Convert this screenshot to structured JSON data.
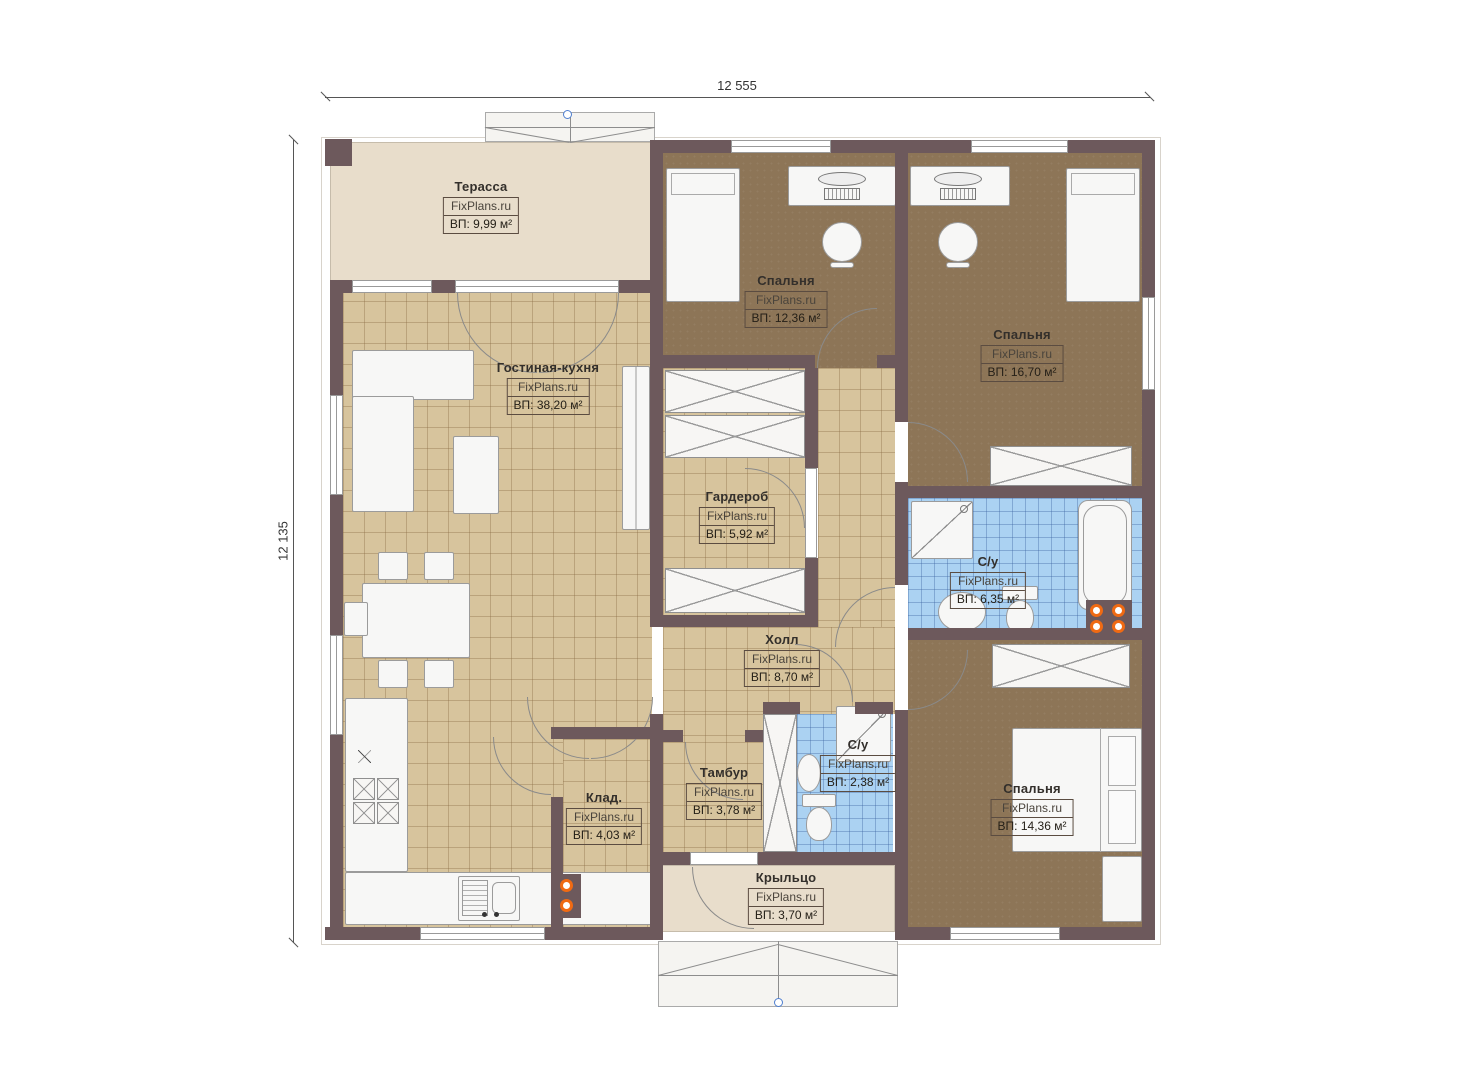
{
  "watermark": "FixPlans.ru",
  "dimensions": {
    "width_top": "12 555",
    "height_left": "12 135"
  },
  "rooms": {
    "terrace": {
      "name": "Терасса",
      "area": "ВП: 9,99 м²"
    },
    "living": {
      "name": "Гостиная-кухня",
      "area": "ВП: 38,20 м²"
    },
    "bedroom1": {
      "name": "Спальня",
      "area": "ВП: 12,36 м²"
    },
    "bedroom2": {
      "name": "Спальня",
      "area": "ВП: 16,70 м²"
    },
    "wardrobe": {
      "name": "Гардероб",
      "area": "ВП: 5,92 м²"
    },
    "bath1": {
      "name": "С/у",
      "area": "ВП: 6,35 м²"
    },
    "hall": {
      "name": "Холл",
      "area": "ВП: 8,70 м²"
    },
    "storage": {
      "name": "Клад.",
      "area": "ВП: 4,03 м²"
    },
    "tambour": {
      "name": "Тамбур",
      "area": "ВП: 3,78 м²"
    },
    "bath2": {
      "name": "С/у",
      "area": "ВП: 2,38 м²"
    },
    "bedroom3": {
      "name": "Спальня",
      "area": "ВП: 14,36 м²"
    },
    "porch": {
      "name": "Крыльцо",
      "area": "ВП: 3,70 м²"
    }
  },
  "colors": {
    "wall": "#6d595c",
    "tile": "#d7c49d",
    "wood": "#8d7557",
    "bath": "#abd2f2",
    "cream": "#e8ddcb",
    "radiator": "#f06a13",
    "marker": "#4f7fd0"
  }
}
